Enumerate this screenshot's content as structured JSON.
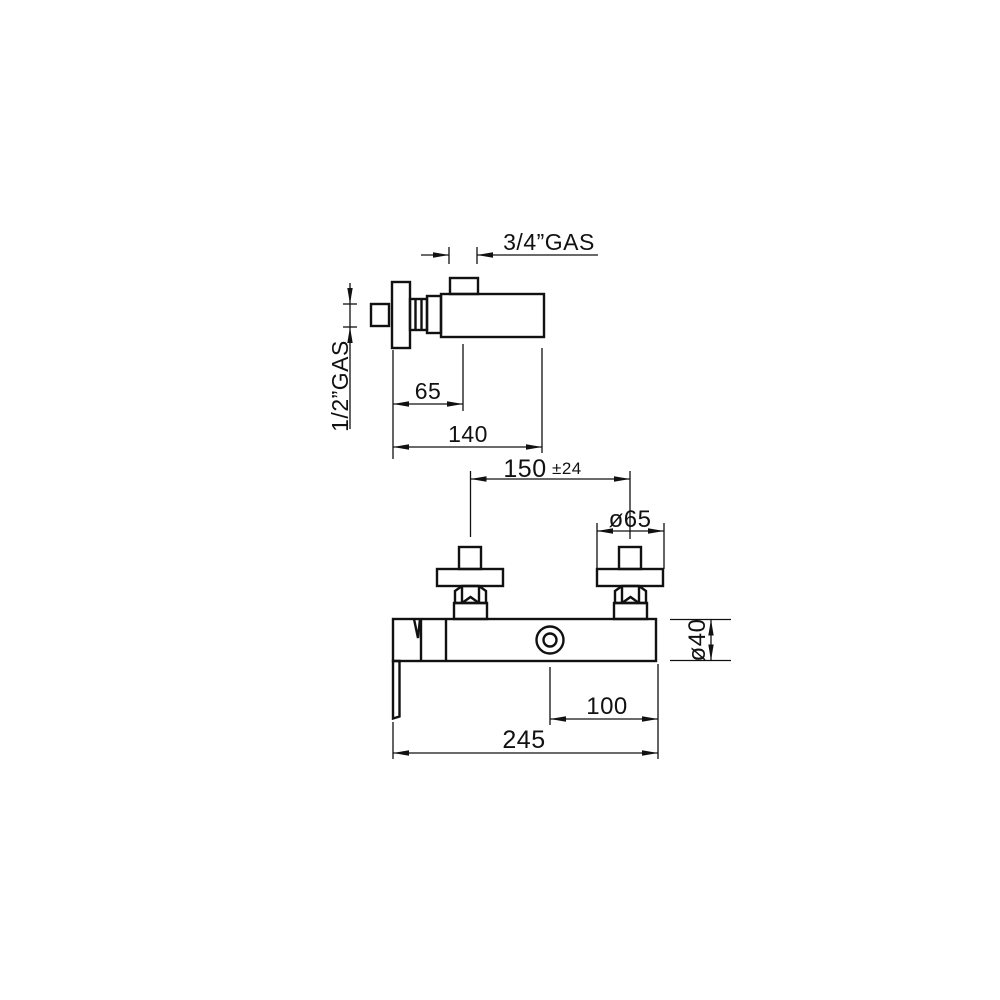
{
  "colors": {
    "background": "#ffffff",
    "line": "#111111"
  },
  "labels": {
    "outlet_thread": "3/4”GAS",
    "inlet_thread": "1/2”GAS"
  },
  "dims": {
    "wall_to_outlet_center": "65",
    "overall_depth": "140",
    "inlet_centers": "150",
    "inlet_centers_tolerance": "±24",
    "flange_diameter": "ø65",
    "body_diameter": "ø40",
    "center_to_right_end": "100",
    "overall_width": "245"
  }
}
